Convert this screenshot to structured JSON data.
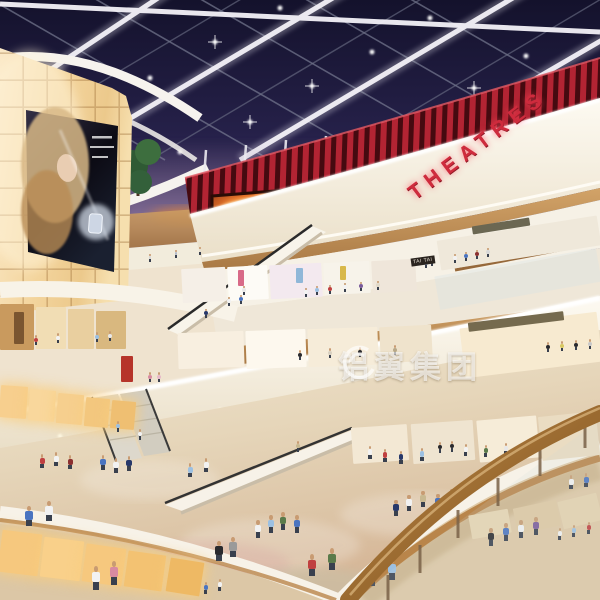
{
  "scene": {
    "setting": "Multi-level shopping mall atrium interior rendering at dusk, glass skylight roof, curved balconies, escalators and shoppers",
    "watermark": {
      "text": "铝翼集团"
    },
    "signs": {
      "theatres": "THEATRES",
      "tai_tai": "TAI TAI"
    },
    "palette": {
      "sky_top": "#14122c",
      "sky_horizon": "#8a7494",
      "beam_white": "#eceaf2",
      "theatre_red": "#cf2b3d",
      "wood": "#c1914f",
      "cream": "#f7f0e0",
      "lightbox_amber": "#f3d49c",
      "floor_beige": "#e6d3b4",
      "fire_glow": "#e8762a",
      "watermark_white": "rgba(255,255,255,0.62)"
    },
    "figures": [
      {
        "x": 455,
        "y": 263,
        "h": 9,
        "c": "#f2f2f2"
      },
      {
        "x": 466,
        "y": 261,
        "h": 9,
        "c": "#4a74c0"
      },
      {
        "x": 477,
        "y": 259,
        "h": 9,
        "c": "#8c3030"
      },
      {
        "x": 488,
        "y": 257,
        "h": 9,
        "c": "#d8d8d8"
      },
      {
        "x": 426,
        "y": 268,
        "h": 9,
        "c": "#6a86b8"
      },
      {
        "x": 432,
        "y": 266,
        "h": 9,
        "c": "#e8e8e8"
      },
      {
        "x": 306,
        "y": 297,
        "h": 9,
        "c": "#f2f2f2"
      },
      {
        "x": 317,
        "y": 295,
        "h": 9,
        "c": "#9cc0e2"
      },
      {
        "x": 330,
        "y": 294,
        "h": 9,
        "c": "#c04040"
      },
      {
        "x": 345,
        "y": 292,
        "h": 9,
        "c": "#f2f2f2"
      },
      {
        "x": 361,
        "y": 291,
        "h": 9,
        "c": "#7a5a9a"
      },
      {
        "x": 378,
        "y": 290,
        "h": 9,
        "c": "#e0d8c8"
      },
      {
        "x": 229,
        "y": 306,
        "h": 9,
        "c": "#f2f2f2"
      },
      {
        "x": 241,
        "y": 304,
        "h": 9,
        "c": "#4a74c0"
      },
      {
        "x": 206,
        "y": 318,
        "h": 9,
        "c": "#27386a"
      },
      {
        "x": 244,
        "y": 295,
        "h": 9,
        "c": "#e8e8e8"
      },
      {
        "x": 150,
        "y": 262,
        "h": 8,
        "c": "#d8d8d8"
      },
      {
        "x": 176,
        "y": 258,
        "h": 8,
        "c": "#b0b8c8"
      },
      {
        "x": 200,
        "y": 255,
        "h": 8,
        "c": "#e8e0d0"
      },
      {
        "x": 36,
        "y": 345,
        "h": 10,
        "c": "#c04040"
      },
      {
        "x": 58,
        "y": 343,
        "h": 10,
        "c": "#f2f2f2"
      },
      {
        "x": 97,
        "y": 342,
        "h": 10,
        "c": "#9cc0e2"
      },
      {
        "x": 110,
        "y": 341,
        "h": 10,
        "c": "#e8e8e8"
      },
      {
        "x": 150,
        "y": 382,
        "h": 10,
        "c": "#d88aa0"
      },
      {
        "x": 159,
        "y": 382,
        "h": 10,
        "c": "#e8b8c8"
      },
      {
        "x": 548,
        "y": 352,
        "h": 10,
        "c": "#2a2a2e"
      },
      {
        "x": 562,
        "y": 351,
        "h": 10,
        "c": "#d8c860"
      },
      {
        "x": 576,
        "y": 350,
        "h": 10,
        "c": "#2a2a2e"
      },
      {
        "x": 590,
        "y": 349,
        "h": 10,
        "c": "#c8c8c8"
      },
      {
        "x": 300,
        "y": 360,
        "h": 10,
        "c": "#2a2a2e"
      },
      {
        "x": 330,
        "y": 358,
        "h": 10,
        "c": "#d8d0c0"
      },
      {
        "x": 360,
        "y": 357,
        "h": 10,
        "c": "#2a2a2e"
      },
      {
        "x": 395,
        "y": 355,
        "h": 10,
        "c": "#b8a888"
      },
      {
        "x": 370,
        "y": 459,
        "h": 13,
        "c": "#f2f2f2"
      },
      {
        "x": 385,
        "y": 462,
        "h": 13,
        "c": "#c04040"
      },
      {
        "x": 401,
        "y": 464,
        "h": 13,
        "c": "#27386a"
      },
      {
        "x": 422,
        "y": 461,
        "h": 13,
        "c": "#9cc0e2"
      },
      {
        "x": 466,
        "y": 456,
        "h": 12,
        "c": "#f2f2f2"
      },
      {
        "x": 486,
        "y": 457,
        "h": 12,
        "c": "#5a7a4a"
      },
      {
        "x": 506,
        "y": 455,
        "h": 12,
        "c": "#e8e8e8"
      },
      {
        "x": 440,
        "y": 453,
        "h": 11,
        "c": "#2a2a2e"
      },
      {
        "x": 452,
        "y": 452,
        "h": 11,
        "c": "#2a2a2e"
      },
      {
        "x": 586,
        "y": 487,
        "h": 14,
        "c": "#4a74c0"
      },
      {
        "x": 571,
        "y": 489,
        "h": 14,
        "c": "#f2f2f2"
      },
      {
        "x": 118,
        "y": 432,
        "h": 11,
        "c": "#9cc0e2"
      },
      {
        "x": 140,
        "y": 440,
        "h": 11,
        "c": "#f2f2f2"
      },
      {
        "x": 298,
        "y": 452,
        "h": 11,
        "c": "#c8b890"
      },
      {
        "x": 103,
        "y": 470,
        "h": 15,
        "c": "#4a74c0"
      },
      {
        "x": 116,
        "y": 473,
        "h": 15,
        "c": "#f2f2f2"
      },
      {
        "x": 129,
        "y": 471,
        "h": 15,
        "c": "#27386a"
      },
      {
        "x": 190,
        "y": 477,
        "h": 14,
        "c": "#9cc0e2"
      },
      {
        "x": 206,
        "y": 472,
        "h": 14,
        "c": "#f2f2f2"
      },
      {
        "x": 42,
        "y": 468,
        "h": 14,
        "c": "#c04040"
      },
      {
        "x": 56,
        "y": 466,
        "h": 14,
        "c": "#f2f2f2"
      },
      {
        "x": 70,
        "y": 469,
        "h": 14,
        "c": "#8c3030"
      },
      {
        "x": 258,
        "y": 538,
        "h": 18,
        "c": "#f2f2f2"
      },
      {
        "x": 271,
        "y": 533,
        "h": 18,
        "c": "#9cc0e2"
      },
      {
        "x": 283,
        "y": 530,
        "h": 18,
        "c": "#5a7a4a"
      },
      {
        "x": 297,
        "y": 533,
        "h": 18,
        "c": "#4a74c0"
      },
      {
        "x": 396,
        "y": 516,
        "h": 16,
        "c": "#27386a"
      },
      {
        "x": 409,
        "y": 511,
        "h": 16,
        "c": "#f2f2f2"
      },
      {
        "x": 423,
        "y": 507,
        "h": 16,
        "c": "#c8b890"
      },
      {
        "x": 438,
        "y": 510,
        "h": 16,
        "c": "#4a74c0"
      },
      {
        "x": 452,
        "y": 505,
        "h": 16,
        "c": "#9a9a9a"
      },
      {
        "x": 491,
        "y": 546,
        "h": 18,
        "c": "#2a2a2e"
      },
      {
        "x": 506,
        "y": 541,
        "h": 18,
        "c": "#4a74c0"
      },
      {
        "x": 521,
        "y": 538,
        "h": 18,
        "c": "#f2f2f2"
      },
      {
        "x": 536,
        "y": 535,
        "h": 18,
        "c": "#7a5a9a"
      },
      {
        "x": 312,
        "y": 576,
        "h": 22,
        "c": "#c04040"
      },
      {
        "x": 332,
        "y": 570,
        "h": 22,
        "c": "#5a7a4a"
      },
      {
        "x": 219,
        "y": 561,
        "h": 20,
        "c": "#2a2a2e"
      },
      {
        "x": 233,
        "y": 557,
        "h": 20,
        "c": "#9a9a9a"
      },
      {
        "x": 29,
        "y": 526,
        "h": 20,
        "c": "#4a74c0"
      },
      {
        "x": 49,
        "y": 521,
        "h": 20,
        "c": "#f2f2f2"
      },
      {
        "x": 96,
        "y": 590,
        "h": 24,
        "c": "#f2f2f2"
      },
      {
        "x": 114,
        "y": 585,
        "h": 24,
        "c": "#d88aa0"
      },
      {
        "x": 560,
        "y": 540,
        "h": 12,
        "c": "#f2f2f2"
      },
      {
        "x": 574,
        "y": 537,
        "h": 12,
        "c": "#9cc0e2"
      },
      {
        "x": 589,
        "y": 534,
        "h": 12,
        "c": "#c04040"
      },
      {
        "x": 206,
        "y": 594,
        "h": 12,
        "c": "#4a74c0"
      },
      {
        "x": 220,
        "y": 591,
        "h": 12,
        "c": "#f2f2f2"
      },
      {
        "x": 372,
        "y": 586,
        "h": 22,
        "c": "#27386a"
      },
      {
        "x": 392,
        "y": 580,
        "h": 22,
        "c": "#9cc0e2"
      }
    ],
    "shops": [
      {
        "x": 0,
        "y": 304,
        "w": 34,
        "h": 46,
        "r": 0,
        "c": "#c99a5e"
      },
      {
        "x": 36,
        "y": 307,
        "w": 30,
        "h": 42,
        "r": 0,
        "c": "#f1ddb4"
      },
      {
        "x": 68,
        "y": 309,
        "w": 26,
        "h": 40,
        "r": 0,
        "c": "#e9cf9f"
      },
      {
        "x": 96,
        "y": 311,
        "w": 30,
        "h": 38,
        "r": 0,
        "c": "#d9b87f"
      },
      {
        "x": 14,
        "y": 312,
        "w": 10,
        "h": 32,
        "r": 0,
        "c": "#7a5530"
      },
      {
        "x": 121,
        "y": 356,
        "w": 12,
        "h": 26,
        "r": 0,
        "c": "#b6342a"
      },
      {
        "x": 182,
        "y": 268,
        "w": 44,
        "h": 34,
        "r": -3,
        "c": "#f5efe7"
      },
      {
        "x": 228,
        "y": 266,
        "w": 40,
        "h": 34,
        "r": -3,
        "c": "#fdfbf6"
      },
      {
        "x": 270,
        "y": 264,
        "w": 52,
        "h": 34,
        "r": -3,
        "c": "#f3e9ef"
      },
      {
        "x": 324,
        "y": 262,
        "w": 46,
        "h": 32,
        "r": -3,
        "c": "#f7f3ea"
      },
      {
        "x": 372,
        "y": 260,
        "w": 44,
        "h": 32,
        "r": -3,
        "c": "#efe6da"
      },
      {
        "x": 238,
        "y": 270,
        "w": 6,
        "h": 16,
        "r": 0,
        "c": "#d86a88"
      },
      {
        "x": 296,
        "y": 268,
        "w": 7,
        "h": 15,
        "r": 0,
        "c": "#8fb7d8"
      },
      {
        "x": 340,
        "y": 266,
        "w": 6,
        "h": 14,
        "r": 0,
        "c": "#d8b84a"
      },
      {
        "x": 178,
        "y": 332,
        "w": 66,
        "h": 36,
        "r": -2,
        "c": "#f8efe0"
      },
      {
        "x": 246,
        "y": 330,
        "w": 60,
        "h": 38,
        "r": -2,
        "c": "#fdf8ee"
      },
      {
        "x": 308,
        "y": 328,
        "w": 70,
        "h": 38,
        "r": -2,
        "c": "#f6ecd9"
      },
      {
        "x": 380,
        "y": 326,
        "w": 52,
        "h": 36,
        "r": -3,
        "c": "#efe3cc"
      },
      {
        "x": 438,
        "y": 228,
        "w": 162,
        "h": 30,
        "r": -9,
        "c": "#efe8da"
      },
      {
        "x": 472,
        "y": 222,
        "w": 58,
        "h": 8,
        "r": -9,
        "c": "#6b6752"
      },
      {
        "x": 436,
        "y": 262,
        "w": 164,
        "h": 34,
        "r": -10,
        "c": "rgba(215,225,228,0.35)"
      },
      {
        "x": 462,
        "y": 320,
        "w": 138,
        "h": 50,
        "r": -7,
        "c": "#f7ead0"
      },
      {
        "x": 468,
        "y": 317,
        "w": 96,
        "h": 9,
        "r": -7,
        "c": "#756a4e"
      },
      {
        "x": 352,
        "y": 426,
        "w": 56,
        "h": 36,
        "r": -4,
        "c": "#f3e8d4"
      },
      {
        "x": 412,
        "y": 422,
        "w": 62,
        "h": 40,
        "r": -4,
        "c": "#efe4d0"
      },
      {
        "x": 478,
        "y": 418,
        "w": 60,
        "h": 42,
        "r": -5,
        "c": "#f6ecd8"
      },
      {
        "x": 540,
        "y": 414,
        "w": 58,
        "h": 44,
        "r": -6,
        "c": "#eadcc2"
      },
      {
        "x": 470,
        "y": 512,
        "w": 40,
        "h": 24,
        "r": -10,
        "c": "#e8d6b2"
      },
      {
        "x": 515,
        "y": 504,
        "w": 44,
        "h": 26,
        "r": -12,
        "c": "#dfc9a2"
      },
      {
        "x": 560,
        "y": 497,
        "w": 40,
        "h": 28,
        "r": -14,
        "c": "#e5d2ae"
      },
      {
        "x": 0,
        "y": 386,
        "w": 27,
        "h": 32,
        "r": 4,
        "c": "#f7cf8e",
        "g": true
      },
      {
        "x": 29,
        "y": 390,
        "w": 26,
        "h": 31,
        "r": 4,
        "c": "#f9d79c",
        "g": true
      },
      {
        "x": 57,
        "y": 394,
        "w": 26,
        "h": 30,
        "r": 5,
        "c": "#f6cf8e",
        "g": true
      },
      {
        "x": 85,
        "y": 398,
        "w": 24,
        "h": 29,
        "r": 5,
        "c": "#f3c77e",
        "g": true
      },
      {
        "x": 111,
        "y": 401,
        "w": 24,
        "h": 28,
        "r": 5,
        "c": "#efbf72",
        "g": true
      },
      {
        "x": 0,
        "y": 532,
        "w": 40,
        "h": 42,
        "r": 7,
        "c": "#f6c87e",
        "g": true
      },
      {
        "x": 42,
        "y": 539,
        "w": 40,
        "h": 40,
        "r": 7,
        "c": "#f9d08a",
        "g": true
      },
      {
        "x": 84,
        "y": 546,
        "w": 40,
        "h": 38,
        "r": 8,
        "c": "#f6c87e",
        "g": true
      },
      {
        "x": 126,
        "y": 553,
        "w": 38,
        "h": 36,
        "r": 8,
        "c": "#f3c272",
        "g": true
      },
      {
        "x": 168,
        "y": 560,
        "w": 34,
        "h": 34,
        "r": 9,
        "c": "#eeb964",
        "g": true
      }
    ]
  }
}
